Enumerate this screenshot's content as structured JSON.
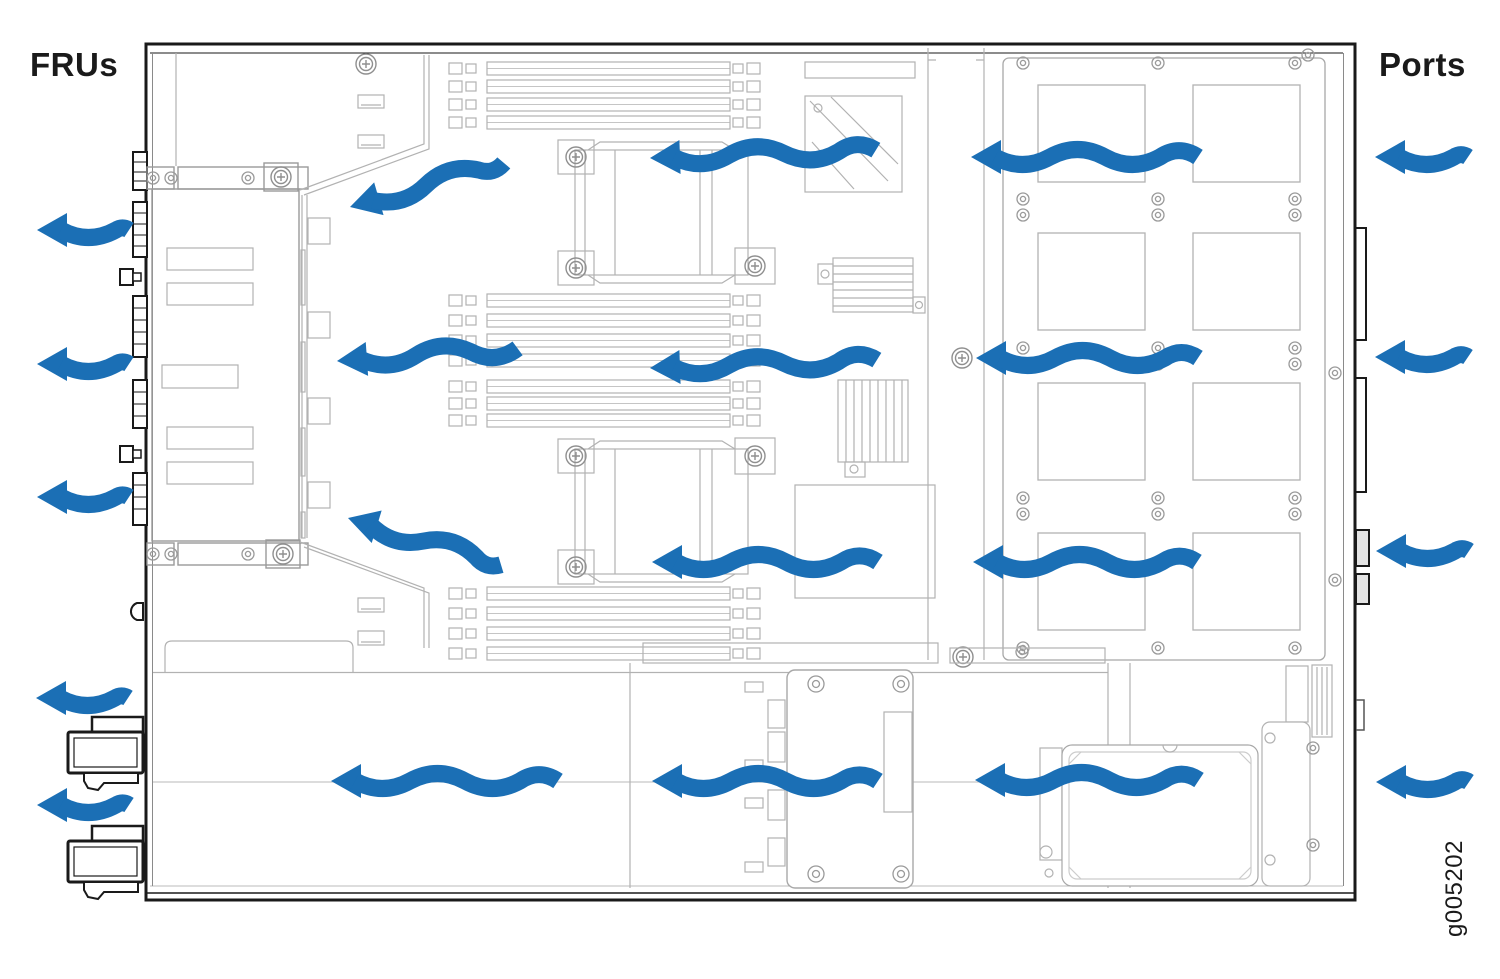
{
  "figure": {
    "type": "chassis-airflow-diagram",
    "left_label": "FRUs",
    "right_label": "Ports",
    "figure_id": "g005202",
    "airflow_direction": "right-to-left"
  },
  "colors": {
    "arrow_blue": "#1b6fb5",
    "label_ink": "#1a1a1a",
    "background": "#ffffff",
    "chassis_line": "#1a1a1a",
    "detail_line": "#b2b2b2"
  },
  "airflow_arrows": {
    "exterior_left": [
      {
        "x": 37,
        "y": 230,
        "len": 92,
        "rot": 0
      },
      {
        "x": 37,
        "y": 364,
        "len": 92,
        "rot": 0
      },
      {
        "x": 37,
        "y": 497,
        "len": 92,
        "rot": 0
      },
      {
        "x": 36,
        "y": 698,
        "len": 92,
        "rot": 0
      },
      {
        "x": 37,
        "y": 805,
        "len": 92,
        "rot": 0
      }
    ],
    "exterior_right": [
      {
        "x": 1375,
        "y": 157,
        "len": 93,
        "rot": 0
      },
      {
        "x": 1375,
        "y": 357,
        "len": 93,
        "rot": 0
      },
      {
        "x": 1376,
        "y": 551,
        "len": 93,
        "rot": 0
      },
      {
        "x": 1376,
        "y": 782,
        "len": 93,
        "rot": 0
      }
    ],
    "interior": [
      {
        "x": 350,
        "y": 207,
        "len": 160,
        "rot": -16
      },
      {
        "x": 650,
        "y": 158,
        "len": 226,
        "rot": -2
      },
      {
        "x": 971,
        "y": 157,
        "len": 227,
        "rot": 0
      },
      {
        "x": 337,
        "y": 361,
        "len": 181,
        "rot": -4
      },
      {
        "x": 650,
        "y": 368,
        "len": 227,
        "rot": -2
      },
      {
        "x": 976,
        "y": 358,
        "len": 222,
        "rot": 0
      },
      {
        "x": 348,
        "y": 518,
        "len": 160,
        "rot": 17
      },
      {
        "x": 652,
        "y": 562,
        "len": 226,
        "rot": 0
      },
      {
        "x": 973,
        "y": 562,
        "len": 224,
        "rot": 0
      },
      {
        "x": 331,
        "y": 781,
        "len": 227,
        "rot": 0
      },
      {
        "x": 652,
        "y": 781,
        "len": 226,
        "rot": 0
      },
      {
        "x": 975,
        "y": 780,
        "len": 224,
        "rot": 0
      }
    ]
  }
}
